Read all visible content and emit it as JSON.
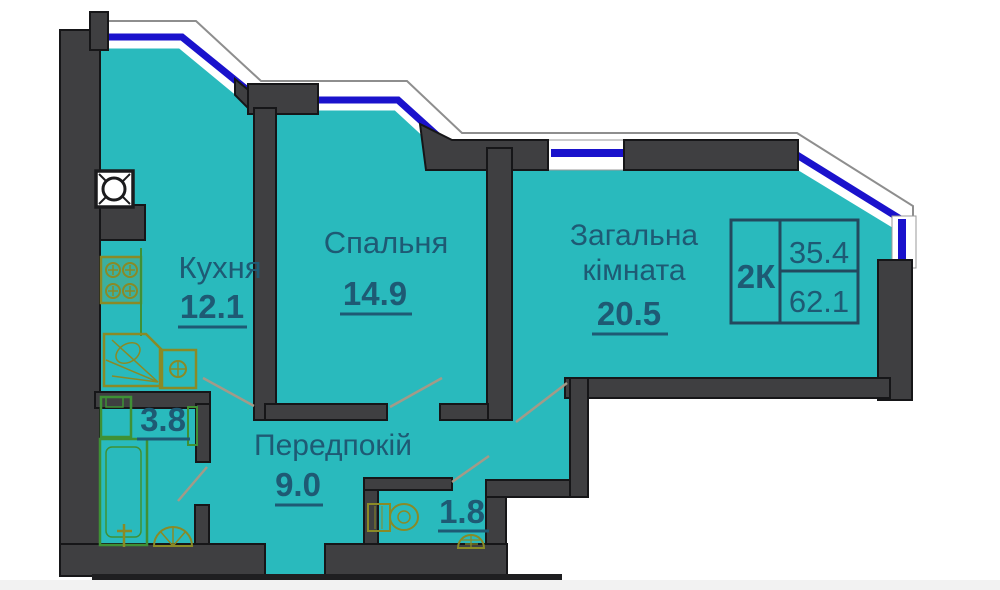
{
  "plan": {
    "rooms": {
      "kitchen": {
        "name": "Кухня",
        "area": "12.1"
      },
      "bedroom": {
        "name": "Спальня",
        "area": "14.9"
      },
      "living": {
        "name_line1": "Загальна",
        "name_line2": "кімната",
        "area": "20.5"
      },
      "hall": {
        "name": "Передпокій",
        "area": "9.0"
      },
      "bathroom": {
        "area": "3.8"
      },
      "wc": {
        "area": "1.8"
      }
    },
    "info_table": {
      "apartment_type": "2К",
      "living_area": "35.4",
      "total_area": "62.1"
    },
    "fixtures": [
      "ventilation-shaft",
      "gas-stove",
      "kitchen-sink",
      "dishwasher",
      "washing-machine",
      "bathtub",
      "faucet",
      "toilet",
      "toilet-with-tank",
      "vent-fan"
    ],
    "colors": {
      "floor": "#29babd",
      "wall": "#3f3f41",
      "window_blue": "#1a12cc",
      "label_text": "#1e5a74",
      "fixture_olive": "#8a8a26",
      "fixture_green": "#3f9135"
    }
  }
}
